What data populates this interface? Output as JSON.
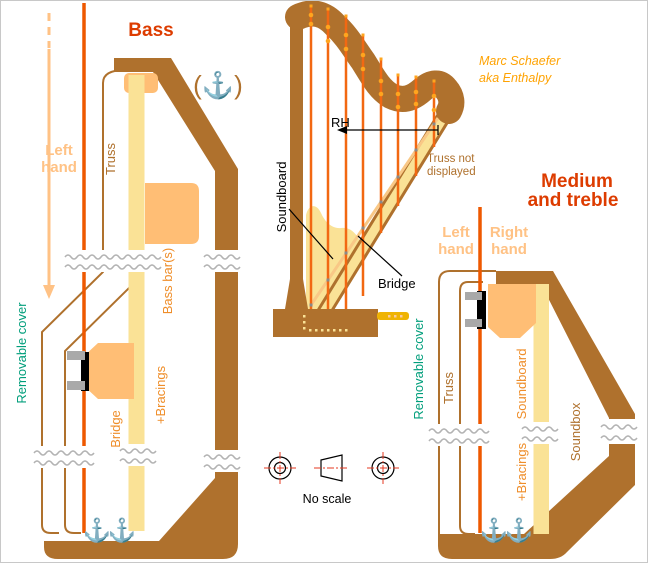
{
  "credit": {
    "line1": "Marc Schaefer",
    "line2": "aka Enthalpy"
  },
  "titles": {
    "bass": "Bass",
    "medium_line1": "Medium",
    "medium_line2": "and treble"
  },
  "hands": {
    "left1": "Left",
    "left2": "hand",
    "right1": "Right",
    "right2": "hand"
  },
  "bass": {
    "truss": "Truss",
    "bass_bars": "Bass bar(s)",
    "bridge": "Bridge",
    "bracings": "+Bracings",
    "cover": "Removable cover"
  },
  "medium": {
    "truss": "Truss",
    "soundboard": "Soundboard",
    "bracings": "+Bracings",
    "soundbox": "Soundbox",
    "cover": "Removable cover"
  },
  "harp": {
    "soundboard": "Soundboard",
    "bridge": "Bridge",
    "rh": "RH",
    "truss_note1": "Truss not",
    "truss_note2": "displayed"
  },
  "footer": {
    "no_scale": "No scale"
  },
  "icons": {
    "anchor": "⚓",
    "anchor_parenthesized": "(⚓)"
  },
  "colors": {
    "wood": "#AF712D",
    "cream": "#FAE296",
    "block_orange": "#FFBE75",
    "string_red": "#EE5800",
    "harp_string": "#F26812",
    "title_red": "#DD3C00",
    "hand_orange": "#FFC285",
    "label_orange": "#EF8E2A",
    "teal": "#009E7B",
    "credit_orange": "#FFA303",
    "crosshair_red": "#E53922",
    "pin_gray": "#A9A9A9",
    "break_gray": "#B3B3B3",
    "pedal_gold": "#EFB303"
  }
}
